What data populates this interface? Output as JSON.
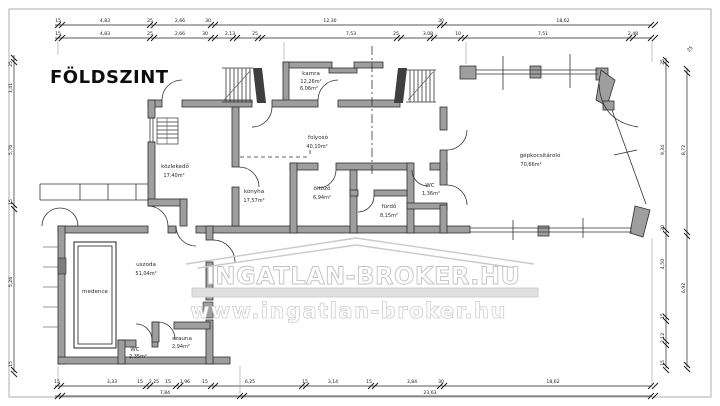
{
  "title": "FÖLDSZINT",
  "watermark": {
    "line1": "INGATLAN-BROKER.HU",
    "line2": "www.ingatlan-broker.hu"
  },
  "colors": {
    "wall_gray": "#9e9e9e",
    "watermark_gray": "#c9c9c9",
    "line_black": "#2f2f2f"
  },
  "rooms": {
    "kamra": {
      "name": "kamra",
      "area1": "12,26m²",
      "area2": "6,06m²"
    },
    "folyoso": {
      "name": "folyosó",
      "area": "40,10m²"
    },
    "kozlekedo": {
      "name": "közlekedő",
      "area": "17,40m²"
    },
    "konyha": {
      "name": "konyha",
      "area": "17,57m²"
    },
    "oltozo": {
      "name": "öltöző",
      "area": "6,94m²"
    },
    "furdo": {
      "name": "fürdő",
      "area": "8,15m²"
    },
    "wc1": {
      "name": "WC",
      "area": "1,36m²"
    },
    "garazs": {
      "name": "gépkocsitároló",
      "area": "70,66m²"
    },
    "uszoda": {
      "name": "uszoda",
      "area": "51,04m²"
    },
    "medence": {
      "name": "medence"
    },
    "wc2": {
      "name": "WC",
      "area": "2,35m²"
    },
    "szauna": {
      "name": "szauna",
      "area": "2,94m²"
    }
  },
  "dims": {
    "top1": [
      "15",
      "4,83",
      "25",
      "2,66",
      "30",
      "12,30",
      "30",
      "18,62"
    ],
    "top2": [
      "15",
      "4,83",
      "25",
      "2,66",
      "30",
      "2,13",
      "25",
      "7,53",
      "25",
      "3,08",
      "10",
      "7,51",
      "2,48"
    ],
    "bottom1": [
      "15",
      "3,33",
      "15",
      "2,25",
      "15",
      "1,96",
      "15",
      "6,25",
      "15",
      "3,14",
      "15",
      "3,84",
      "30",
      "18,62"
    ],
    "bottom2": [
      "7,84",
      "23,63"
    ],
    "left": [
      "25",
      "1,41",
      "5,76",
      "15",
      "5,26",
      "15"
    ],
    "right_inner": [
      "25",
      "9,34",
      "30",
      "4,50",
      "15",
      "2,12",
      "15"
    ],
    "right_outer": [
      "8,72",
      "6,92"
    ],
    "corner": "25"
  }
}
